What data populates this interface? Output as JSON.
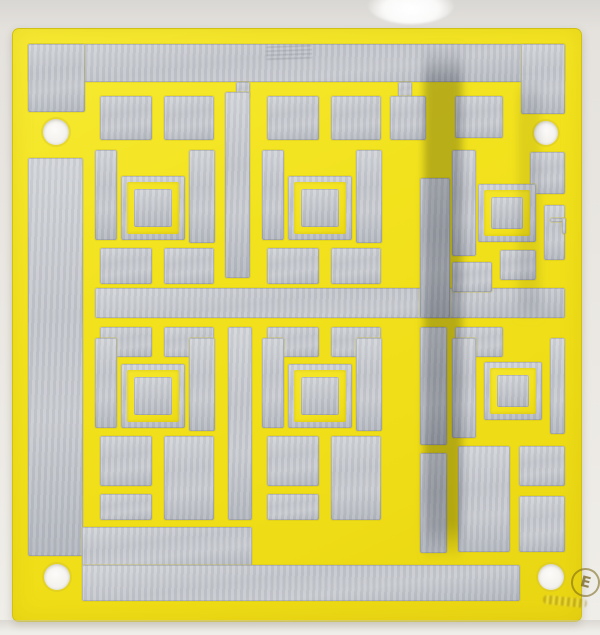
{
  "scene": {
    "description": "Photograph of a yellow printed circuit board panel with tinned silver pads arranged in a maze-like square-in-square test pattern, four white mounting holes, a dark oxidation streak, and a circled certification mark",
    "colors": {
      "background": "#eae7e2",
      "board_yellow": "#f2e21d",
      "board_edge": "#cfc013",
      "pad_silver": "#c2c5cb",
      "pad_silver_dark": "#b2b6be",
      "pad_silver_light": "#d2d5d9",
      "streak": "#333a49",
      "hole_fill": "#f4f2ee",
      "marking_color": "#7d6a12"
    },
    "marking": {
      "letter": "E"
    },
    "holes": [
      {
        "cx": 56,
        "cy": 132,
        "r": 13
      },
      {
        "cx": 546,
        "cy": 133,
        "r": 12
      },
      {
        "cx": 57,
        "cy": 577,
        "r": 13
      },
      {
        "cx": 551,
        "cy": 577,
        "r": 13
      }
    ],
    "streaks": [
      {
        "x": 424,
        "y": 44,
        "w": 38,
        "h": 516,
        "opacity": 0.3
      },
      {
        "x": 518,
        "y": 80,
        "w": 22,
        "h": 240,
        "opacity": 0.1
      }
    ],
    "pads": [
      [
        28,
        44,
        537,
        38
      ],
      [
        28,
        44,
        57,
        68
      ],
      [
        521,
        44,
        44,
        70
      ],
      [
        236,
        82,
        14,
        16
      ],
      [
        398,
        82,
        14,
        16
      ],
      [
        28,
        158,
        55,
        398
      ],
      [
        95,
        288,
        470,
        30
      ],
      [
        82,
        527,
        170,
        40
      ],
      [
        82,
        565,
        438,
        36
      ],
      [
        100,
        96,
        52,
        44
      ],
      [
        164,
        96,
        50,
        44
      ],
      [
        95,
        150,
        22,
        90
      ],
      [
        189,
        150,
        26,
        93
      ],
      [
        100,
        248,
        52,
        36
      ],
      [
        164,
        248,
        50,
        36
      ],
      [
        267,
        96,
        52,
        44
      ],
      [
        331,
        96,
        50,
        44
      ],
      [
        262,
        150,
        22,
        90
      ],
      [
        356,
        150,
        26,
        93
      ],
      [
        267,
        248,
        52,
        36
      ],
      [
        331,
        248,
        50,
        36
      ],
      [
        100,
        327,
        52,
        30
      ],
      [
        164,
        327,
        50,
        30
      ],
      [
        95,
        338,
        22,
        90
      ],
      [
        189,
        338,
        26,
        93
      ],
      [
        100,
        436,
        52,
        50
      ],
      [
        164,
        436,
        50,
        84
      ],
      [
        100,
        494,
        52,
        26
      ],
      [
        267,
        327,
        52,
        30
      ],
      [
        331,
        327,
        50,
        30
      ],
      [
        262,
        338,
        22,
        90
      ],
      [
        356,
        338,
        26,
        93
      ],
      [
        267,
        436,
        52,
        50
      ],
      [
        331,
        436,
        50,
        84
      ],
      [
        267,
        494,
        52,
        26
      ],
      [
        225,
        92,
        25,
        186
      ],
      [
        420,
        178,
        30,
        140
      ],
      [
        390,
        96,
        36,
        44
      ],
      [
        228,
        327,
        24,
        193
      ],
      [
        420,
        327,
        27,
        118
      ],
      [
        420,
        453,
        27,
        100
      ],
      [
        455,
        96,
        48,
        42
      ],
      [
        452,
        150,
        24,
        106
      ],
      [
        530,
        152,
        35,
        42
      ],
      [
        452,
        262,
        40,
        30
      ],
      [
        500,
        250,
        36,
        30
      ],
      [
        544,
        205,
        21,
        55
      ],
      [
        455,
        327,
        48,
        30
      ],
      [
        452,
        338,
        24,
        100
      ],
      [
        550,
        338,
        15,
        96
      ],
      [
        458,
        446,
        52,
        106
      ],
      [
        519,
        446,
        46,
        40
      ],
      [
        519,
        496,
        46,
        56
      ],
      [
        550,
        218,
        16,
        4
      ],
      [
        562,
        218,
        4,
        16
      ]
    ],
    "rings": [
      {
        "x": 121,
        "y": 176,
        "s": 64
      },
      {
        "x": 288,
        "y": 176,
        "s": 64
      },
      {
        "x": 121,
        "y": 364,
        "s": 64
      },
      {
        "x": 288,
        "y": 364,
        "s": 64
      },
      {
        "x": 478,
        "y": 184,
        "s": 58
      },
      {
        "x": 484,
        "y": 362,
        "s": 58
      }
    ]
  }
}
